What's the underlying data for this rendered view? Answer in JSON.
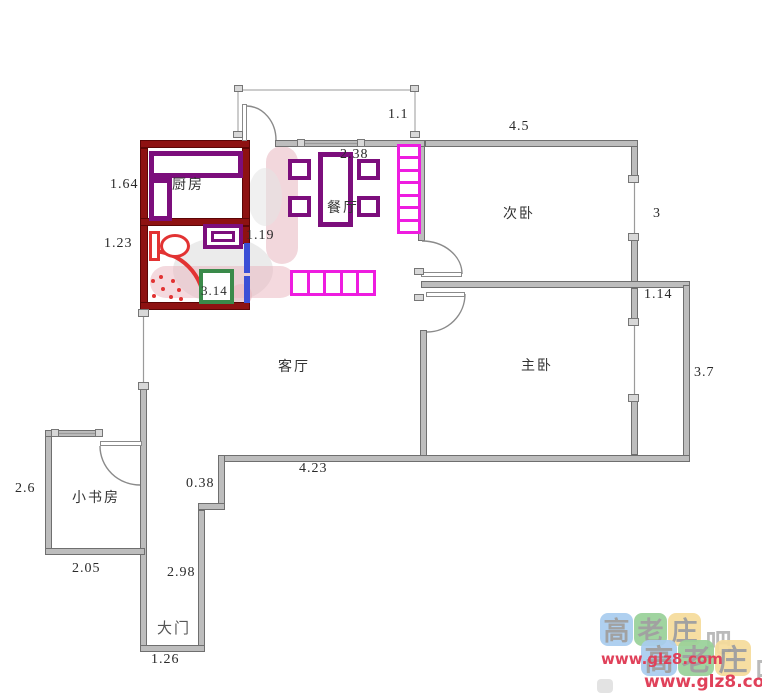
{
  "rooms": {
    "kitchen": "厨房",
    "dining": "餐厅",
    "bedroom2": "次卧",
    "master": "主卧",
    "living": "客厅",
    "study": "小书房",
    "entry": "大门"
  },
  "dimensions": {
    "kitchen_height": "1.64",
    "bath_height": "1.23",
    "bath_door": "1.19",
    "bath_box": "3.14",
    "balcony_depth": "1.1",
    "dining_table": "2.38",
    "bedroom2_width": "4.5",
    "bedroom2_height": "3",
    "bay_width": "1.14",
    "master_height": "3.7",
    "living_width": "4.23",
    "step": "0.38",
    "study_height": "2.6",
    "study_width": "2.05",
    "corridor_height": "2.98",
    "entry_width": "1.26"
  },
  "watermark": {
    "chars": [
      "高",
      "老",
      "庄",
      "吧"
    ],
    "url": "www.glz8.com",
    "colors": {
      "blue": "#a9cdef",
      "green": "#99d199",
      "yellow": "#f6dc9b",
      "url_color": "#e0415a"
    }
  },
  "palette": {
    "wall_gray": "#bdbdbd",
    "wet_wall_red": "#8e1212",
    "furniture_purple": "#7c0e7c",
    "cabinet_magenta": "#ee1ce0",
    "box_green": "#3a8a4a",
    "door_blue": "#3b4fd6",
    "fixture_red": "#e23333"
  }
}
